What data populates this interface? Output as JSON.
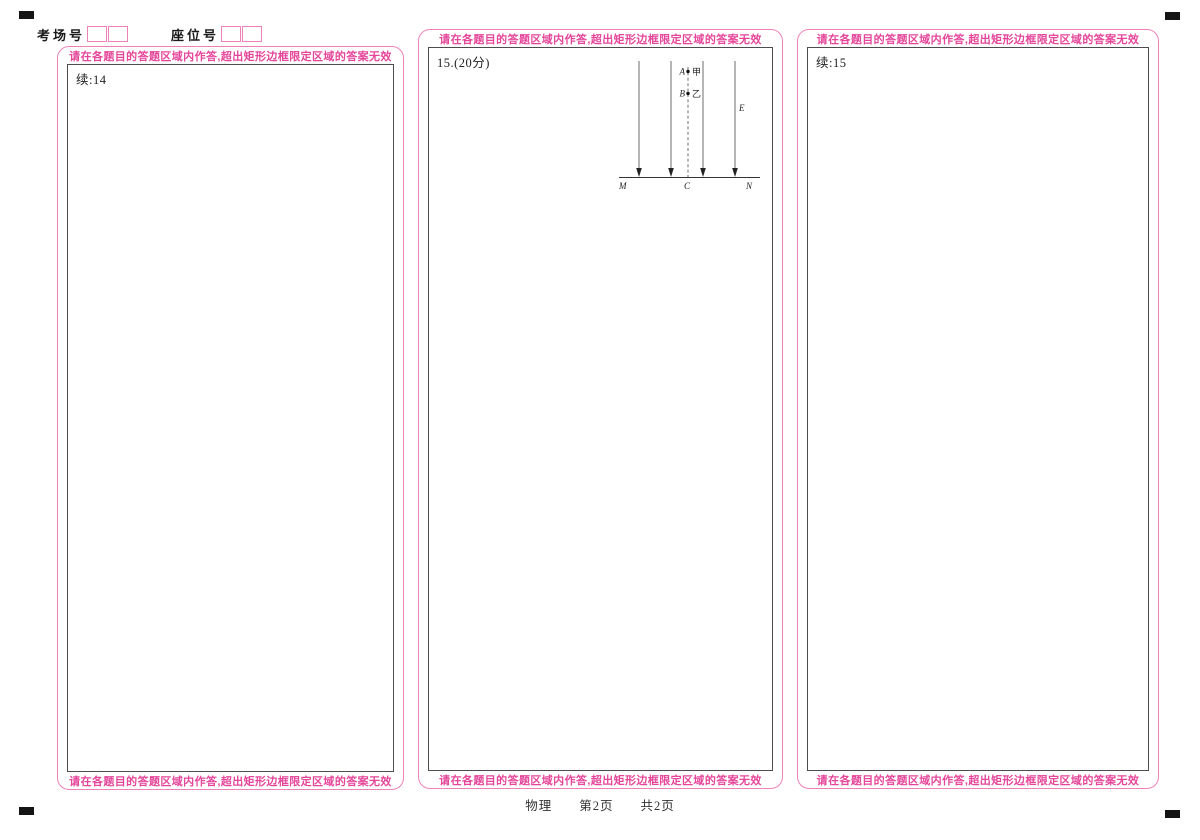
{
  "header": {
    "exam_room_label": "考场号",
    "seat_label": "座位号"
  },
  "warning_text": "请在各题目的答题区域内作答,超出矩形边框限定区域的答案无效",
  "columns": [
    {
      "note": "续:14"
    },
    {
      "note": "15.(20分)"
    },
    {
      "note": "续:15"
    }
  ],
  "diagram": {
    "point_a_label": "A",
    "point_a_name": "甲",
    "point_b_label": "B",
    "point_b_name": "乙",
    "field_label": "E",
    "baseline_left": "M",
    "baseline_center": "C",
    "baseline_right": "N"
  },
  "footer": {
    "subject": "物理",
    "page": "第2页",
    "total": "共2页"
  },
  "colors": {
    "pink_text": "#e5469a",
    "pink_border": "#ee82b8",
    "frame_border": "#4d4d4d"
  }
}
